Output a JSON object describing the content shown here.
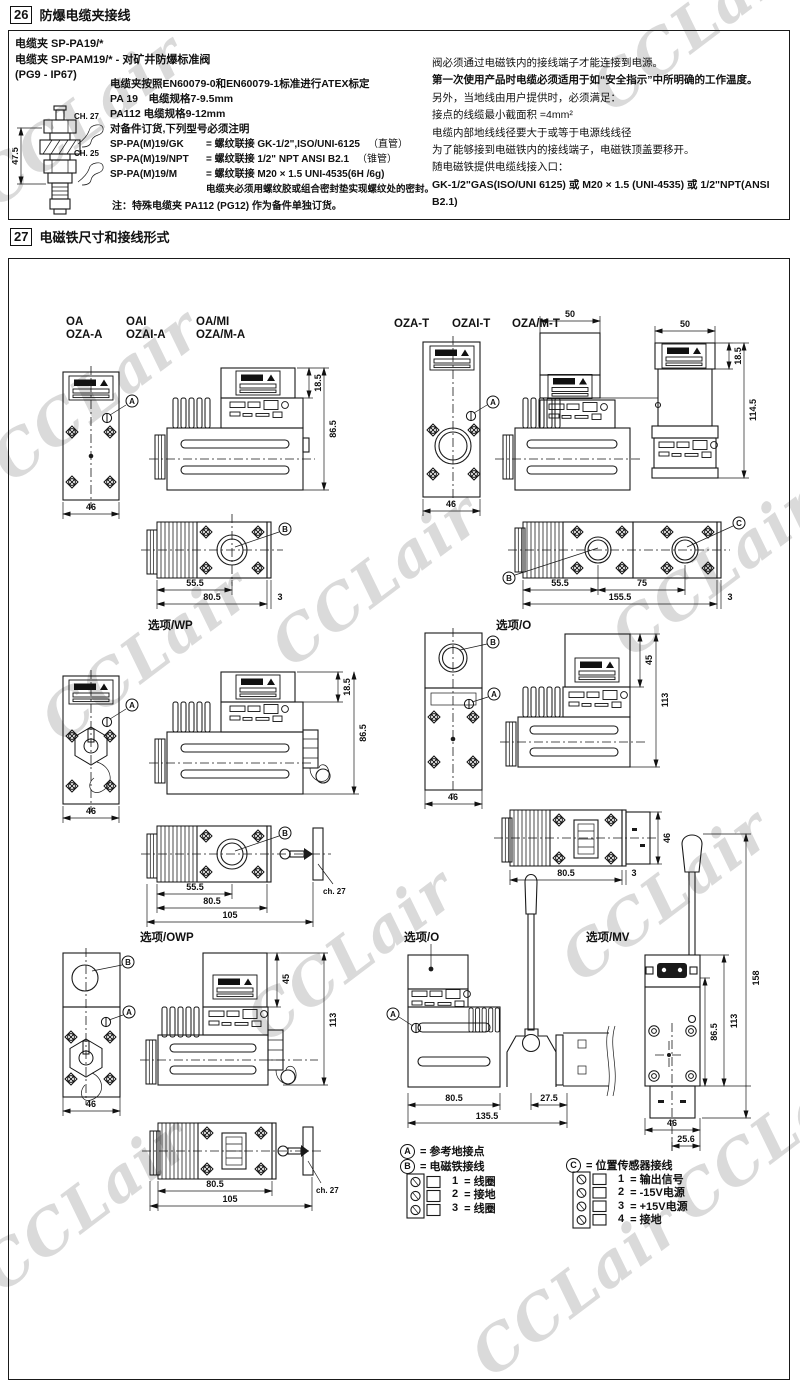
{
  "watermark": {
    "text": "CCLair"
  },
  "s26": {
    "num": "26",
    "title": "防爆电缆夹接线",
    "b1": "电缆夹 SP-PA19/*",
    "b2": "电缆夹 SP-PAM19/* - 对矿井防爆标准阀",
    "b3": "(PG9 - IP67)",
    "atex": "电缆夹按照EN60079-0和EN60079-1标准进行ATEX标定",
    "pa19": "PA 19　电缆规格7-9.5mm",
    "pa112": "PA112 电缆规格9-12mm",
    "order": "对备件订货,下列型号必须注明",
    "models": [
      {
        "code": "SP-PA(M)19/GK",
        "desc": "= 螺纹联接  GK-1/2\",ISO/UNI-6125",
        "paren": "（直管）"
      },
      {
        "code": "SP-PA(M)19/NPT",
        "desc": "= 螺纹联接  1/2\" NPT ANSI B2.1",
        "paren": "（锥管）"
      },
      {
        "code": "SP-PA(M)19/M",
        "desc": "= 螺纹联接  M20 × 1.5 UNI-4535(6H /6g)",
        "paren": ""
      }
    ],
    "seal": "电缆夹必须用螺纹胶或组合密封垫实现螺纹处的密封。",
    "note": "注：特殊电缆夹 PA112 (PG12) 作为备件单独订货。",
    "clamp": {
      "h": "47.5",
      "ch27": "CH. 27",
      "ch25": "CH. 25"
    },
    "r1": "阀必须通过电磁铁内的接线端子才能连接到电源。",
    "r2": "第一次使用产品时电缆必须适用于如“安全指示”中所明确的工作温度。",
    "r3": "另外，当地线由用户提供时，必须满足：",
    "r4": "接点的线缆最小截面积 =4mm²",
    "r5": "电缆内部地线线径要大于或等于电源线线径",
    "r6": "为了能够接到电磁铁内的接线端子，电磁铁顶盖要移开。",
    "r7": "随电磁铁提供电缆线接入口：",
    "r8": "GK-1/2\"GAS(ISO/UNI 6125) 或 M20 × 1.5 (UNI-4535) 或 1/2\"NPT(ANSI B2.1)"
  },
  "s27": {
    "num": "27",
    "title": "电磁铁尺寸和接线形式",
    "refs": {
      "A": "A",
      "B": "B",
      "C": "C"
    },
    "g1": {
      "l1a": "OA",
      "l1b": "OZA-A",
      "l2a": "OAI",
      "l2b": "OZAI-A",
      "l3a": "OA/MI",
      "l3b": "OZA/M-A",
      "w46": "46",
      "t185": "18.5",
      "h865": "86.5",
      "b555": "55.5",
      "b805": "80.5",
      "b3": "3"
    },
    "g2": {
      "l1": "OZA-T",
      "l2": "OZAI-T",
      "l3": "OZA/M-T",
      "d50a": "50",
      "d50b": "50",
      "t185": "18.5",
      "h1145": "114.5",
      "w46": "46",
      "b555": "55.5",
      "b75": "75",
      "b1555": "155.5",
      "b3": "3"
    },
    "g3": {
      "title": "选项/WP",
      "w46": "46",
      "t185": "18.5",
      "h865": "86.5",
      "b555": "55.5",
      "b805": "80.5",
      "b105": "105",
      "ch27": "ch. 27"
    },
    "g4": {
      "title": "选项/O",
      "w46": "46",
      "d45": "45",
      "d113": "113",
      "b805": "80.5",
      "b3": "3",
      "r46": "46"
    },
    "g5": {
      "title": "选项/OWP",
      "w46": "46",
      "d45": "45",
      "d113": "113",
      "b805": "80.5",
      "b105": "105",
      "ch27": "ch. 27"
    },
    "g6": {
      "title": "选项/O",
      "b805": "80.5",
      "b275": "27.5",
      "b1355": "135.5"
    },
    "g7": {
      "title": "选项/MV",
      "d865": "86.5",
      "d113": "113",
      "d158": "158",
      "w46": "46",
      "d256": "25.6"
    },
    "legend": {
      "a_sym": "A",
      "a_text": "= 参考地接点",
      "b_sym": "B",
      "b_text": "= 电磁铁接线",
      "c_sym": "C",
      "c_text": "= 位置传感器接线",
      "b_pins": [
        {
          "n": "1",
          "t": "=  线圈"
        },
        {
          "n": "2",
          "t": "=  接地"
        },
        {
          "n": "3",
          "t": "=  线圈"
        }
      ],
      "c_pins": [
        {
          "n": "1",
          "t": "=  输出信号"
        },
        {
          "n": "2",
          "t": "=  -15V电源"
        },
        {
          "n": "3",
          "t": "=  +15V电源"
        },
        {
          "n": "4",
          "t": "=  接地"
        }
      ]
    }
  }
}
